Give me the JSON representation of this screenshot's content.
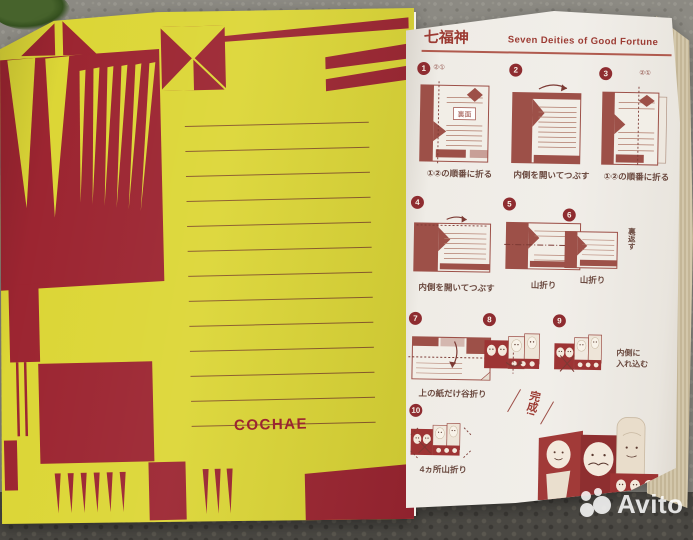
{
  "colors": {
    "yellow": "#dcd636",
    "page_red": "#9c2531",
    "ink_red": "#9c3b33",
    "diagram_red": "#9d5048",
    "paper": "#f0ede8",
    "carpet": "#8c8a83",
    "edge_beige": "#cfc3a6"
  },
  "left_page": {
    "brand": "COCHAE"
  },
  "right_page": {
    "title_ja": "七福神",
    "title_en": "Seven Deities of Good Fortune",
    "finish": "完成!",
    "steps": [
      {
        "num": "1",
        "sub": "②①",
        "label_back": "裏面",
        "caption": "①②の順番に折る"
      },
      {
        "num": "2",
        "caption": "内側を開いてつぶす"
      },
      {
        "num": "3",
        "sub": "②①",
        "caption": "①②の順番に折る"
      },
      {
        "num": "4",
        "caption": "内側を開いてつぶす"
      },
      {
        "num": "5",
        "caption": "山折り"
      },
      {
        "num": "6",
        "caption": "山折り",
        "note": "裏返す"
      },
      {
        "num": "7",
        "caption": "上の紙だけ谷折り"
      },
      {
        "num": "8",
        "caption": ""
      },
      {
        "num": "9",
        "caption": "",
        "note1": "内側に",
        "note2": "入れ込む"
      },
      {
        "num": "10",
        "caption": "4ヵ所山折り"
      }
    ]
  },
  "watermark": {
    "label": "Avito"
  }
}
